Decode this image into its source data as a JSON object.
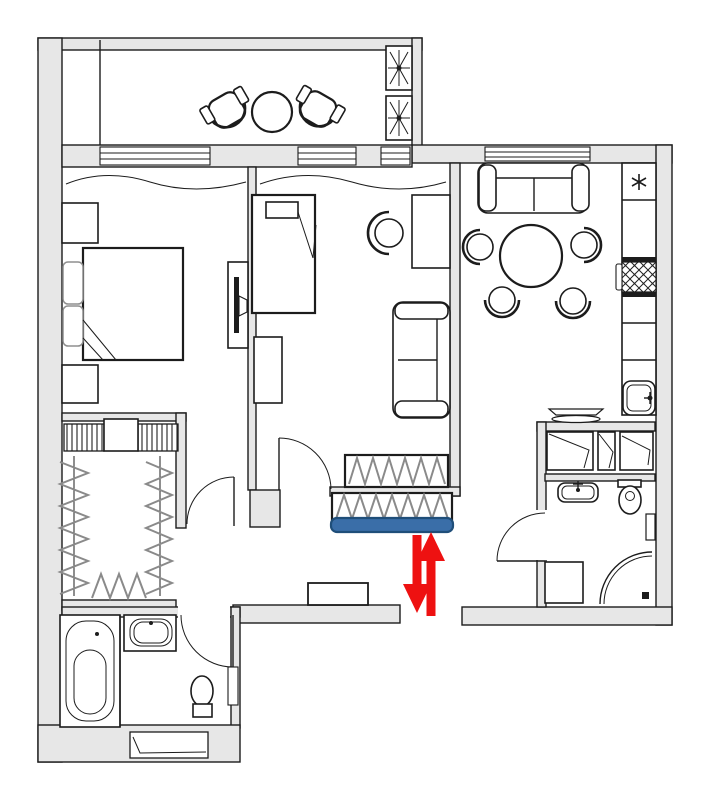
{
  "document": {
    "type": "apartment-floor-plan",
    "title": "Two-room apartment floor plan with balcony",
    "has_text_labels": false
  },
  "colors": {
    "bg": "#ffffff",
    "wall": "#e7e7e7",
    "ink": "#1c1c1c",
    "hanger": "#8a8a8a",
    "red": "#ee1111",
    "blue": "#3a6ea8",
    "blueDark": "#1f4e79"
  },
  "rooms": [
    {
      "id": "balcony",
      "name": "Balcony",
      "furniture": [
        "armchair",
        "armchair",
        "round-table",
        "plant-box",
        "plant-box"
      ]
    },
    {
      "id": "bedroom-1",
      "name": "Bedroom 1",
      "furniture": [
        "double-bed",
        "pillow",
        "pillow",
        "nightstand",
        "nightstand",
        "wall-tv",
        "window-curtain"
      ]
    },
    {
      "id": "bedroom-2",
      "name": "Bedroom 2 / living room",
      "furniture": [
        "single-bed",
        "desk",
        "desk-chair",
        "sofa",
        "cabinet",
        "wardrobe-with-hangers",
        "window-curtain"
      ]
    },
    {
      "id": "kitchen",
      "name": "Kitchen / dining room",
      "furniture": [
        "sofa",
        "round-dining-table",
        "chair",
        "chair",
        "chair",
        "chair",
        "counter",
        "refrigerator",
        "stove",
        "sink",
        "wall-shelf"
      ]
    },
    {
      "id": "walk-in-closet",
      "name": "Walk-in closet",
      "furniture": [
        "shelf-unit",
        "shelf-unit",
        "hanging-rail",
        "hanging-rail",
        "hanging-rail"
      ]
    },
    {
      "id": "bathroom-left",
      "name": "Bathroom (bottom left)",
      "furniture": [
        "bathtub",
        "sink",
        "toilet",
        "doormat"
      ]
    },
    {
      "id": "bathroom-right",
      "name": "Bathroom (right)",
      "furniture": [
        "cabinet",
        "cabinet",
        "cabinet",
        "sink",
        "toilet",
        "washing-machine",
        "corner-shower",
        "radiator"
      ]
    },
    {
      "id": "hallway",
      "name": "Hallway / entrance",
      "furniture": [
        "wardrobe-with-hangers-highlighted",
        "entry-cabinet"
      ]
    }
  ],
  "openings": [
    {
      "id": "entrance-gap",
      "name": "apartment entrance opening (bottom wall)"
    },
    {
      "id": "door-bedroom-1",
      "name": "swing door to bedroom 1"
    },
    {
      "id": "door-bedroom-2",
      "name": "swing door to bedroom 2"
    },
    {
      "id": "door-bathroom-left",
      "name": "swing door to left bathroom"
    },
    {
      "id": "door-bathroom-right",
      "name": "swing door to right bathroom"
    },
    {
      "id": "windows",
      "name": "window band under balcony and kitchen window"
    }
  ],
  "annotations": {
    "highlight_bar": {
      "shape": "rounded horizontal bar",
      "meaning": "highlighted hallway wardrobe near entrance",
      "color": "#3a6ea8",
      "border_color": "#1f4e79"
    },
    "double_arrow": {
      "shape": "two vertical red arrows, one pointing up and one pointing down",
      "meaning": "link between entrance opening and highlighted wardrobe",
      "color": "#ee1111"
    }
  }
}
